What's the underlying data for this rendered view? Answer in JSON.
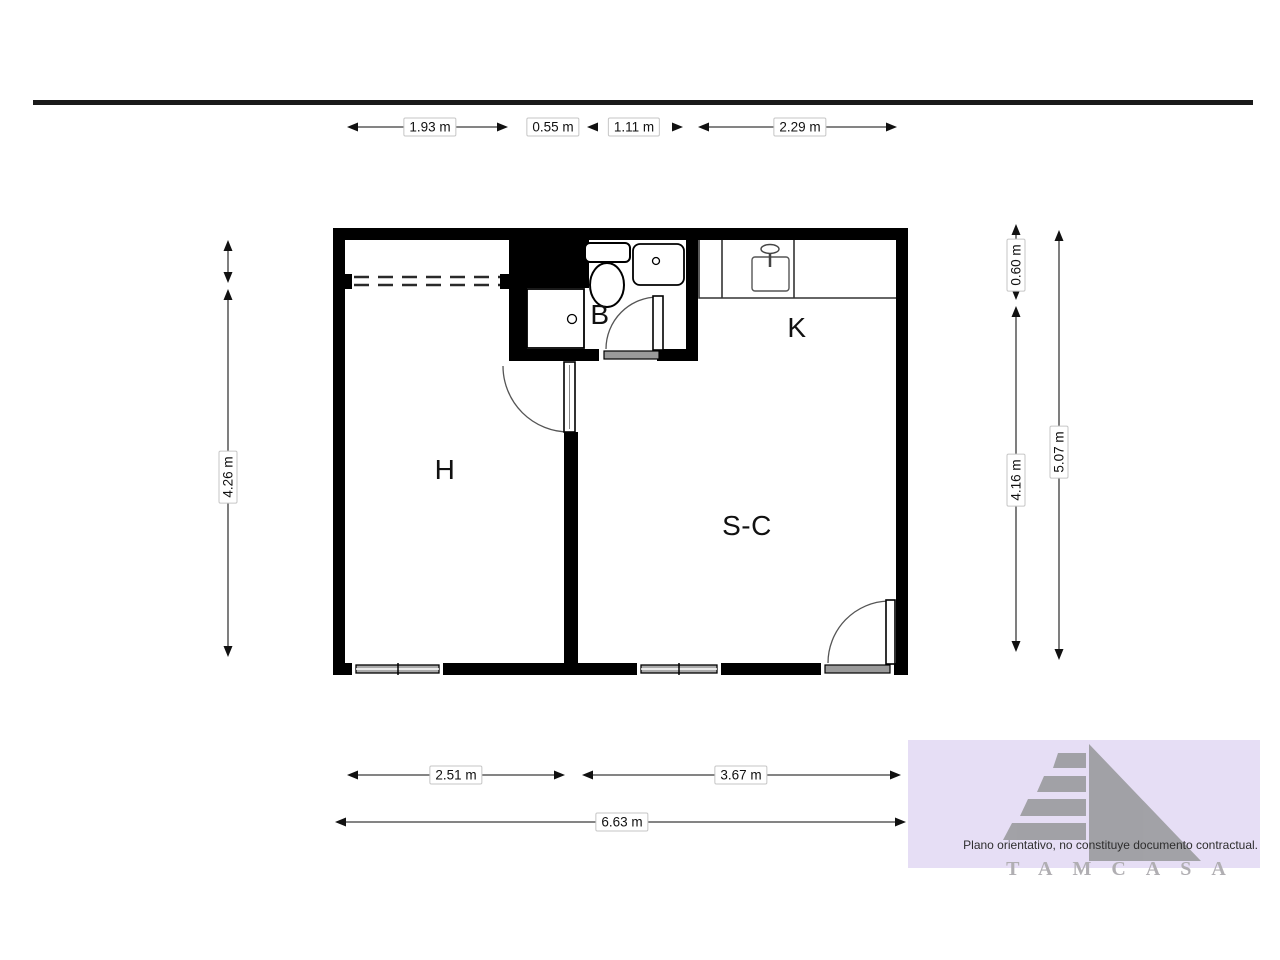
{
  "page": {
    "background": "#ffffff",
    "header_rule_color": "#1a1a1a"
  },
  "plan": {
    "wall_color": "#000000",
    "rooms": {
      "h": {
        "label": "H"
      },
      "b": {
        "label": "B"
      },
      "k": {
        "label": "K"
      },
      "sc": {
        "label": "S-C"
      }
    },
    "fixtures": [
      "toilet",
      "washbasin",
      "shower-tray",
      "wardrobe-dashed-rail",
      "kitchen-counter",
      "kitchen-sink",
      "faucet",
      "interior-door",
      "bathroom-door",
      "entry-door",
      "window"
    ]
  },
  "dimensions": {
    "top": [
      {
        "label": "1.93 m"
      },
      {
        "label": "0.55 m"
      },
      {
        "label": "1.11 m"
      },
      {
        "label": "2.29 m"
      }
    ],
    "bottom": [
      {
        "label": "2.51 m"
      },
      {
        "label": "3.67 m"
      }
    ],
    "overall_width": {
      "label": "6.63 m"
    },
    "left": [
      {
        "label": "4.26 m"
      }
    ],
    "right": [
      {
        "label": "0.60 m"
      },
      {
        "label": "4.16 m"
      }
    ],
    "overall_height": {
      "label": "5.07 m"
    }
  },
  "watermark": {
    "disclaimer": "Plano orientativo, no constituye documento contractual.",
    "brand": "TAMCASA",
    "background_color": "#e6def5",
    "logo_color": "#9c9ca0"
  }
}
